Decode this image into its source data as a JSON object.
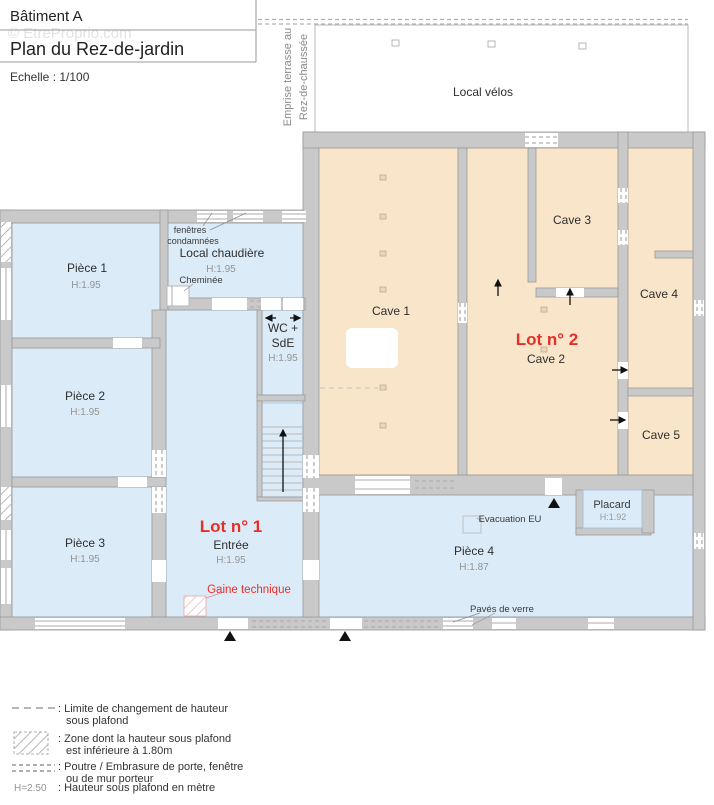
{
  "title_block": {
    "building": "Bâtiment A",
    "plan_title": "Plan du Rez-de-jardin",
    "scale": "Echelle : 1/100"
  },
  "watermark": "© EtreProprio.com",
  "terrace": {
    "line1": "Emprise terrasse au",
    "line2": "Rez-de-chaussée"
  },
  "lots": {
    "lot1": {
      "label": "Lot n° 1",
      "room": "Entrée",
      "height": "H:1.95"
    },
    "lot2": {
      "label": "Lot n° 2",
      "room": "Cave 2"
    }
  },
  "rooms": {
    "local_velos": {
      "name": "Local vélos"
    },
    "piece1": {
      "name": "Pièce 1",
      "height": "H:1.95"
    },
    "piece2": {
      "name": "Pièce 2",
      "height": "H:1.95"
    },
    "piece3": {
      "name": "Pièce 3",
      "height": "H:1.95"
    },
    "piece4": {
      "name": "Pièce 4",
      "height": "H:1.87"
    },
    "local_chaudiere": {
      "name": "Local chaudière",
      "height": "H:1.95"
    },
    "wc_sde": {
      "line1": "WC +",
      "line2": "SdE",
      "height": "H:1.95"
    },
    "cave1": {
      "name": "Cave 1"
    },
    "cave3": {
      "name": "Cave 3"
    },
    "cave4": {
      "name": "Cave 4"
    },
    "cave5": {
      "name": "Cave 5"
    },
    "placard": {
      "name": "Placard",
      "height": "H:1.92"
    }
  },
  "annotations": {
    "fenetres_condamnees_line1": "fenêtres",
    "fenetres_condamnees_line2": "condamnées",
    "cheminee": "Cheminée",
    "gaine_technique": "Gaine technique",
    "evacuation_eu": "Evacuation EU",
    "paves_de_verre": "Pavés de verre"
  },
  "legend": {
    "items": [
      {
        "symbol": "dashed-line",
        "line1": ": Limite de changement de hauteur",
        "line2": "sous plafond"
      },
      {
        "symbol": "hatched-zone",
        "line1": ": Zone dont la hauteur sous plafond",
        "line2": "est inférieure à 1.80m"
      },
      {
        "symbol": "beam-dashes",
        "line1": ": Poutre / Embrasure de porte, fenêtre",
        "line2": "ou de mur porteur"
      },
      {
        "symbol": "height-note",
        "sample": "H=2.50",
        "line1": ": Hauteur sous plafond en mètre",
        "line2": ""
      }
    ]
  },
  "colors": {
    "room_blue": "#dcebf8",
    "cave_peach": "#f9e5c9",
    "wall_gray": "#c9c9c9",
    "wall_stroke": "#9a9a9a",
    "lot_red": "#e43028",
    "muted_text": "#8f8f8f",
    "dark_text": "#333333"
  }
}
